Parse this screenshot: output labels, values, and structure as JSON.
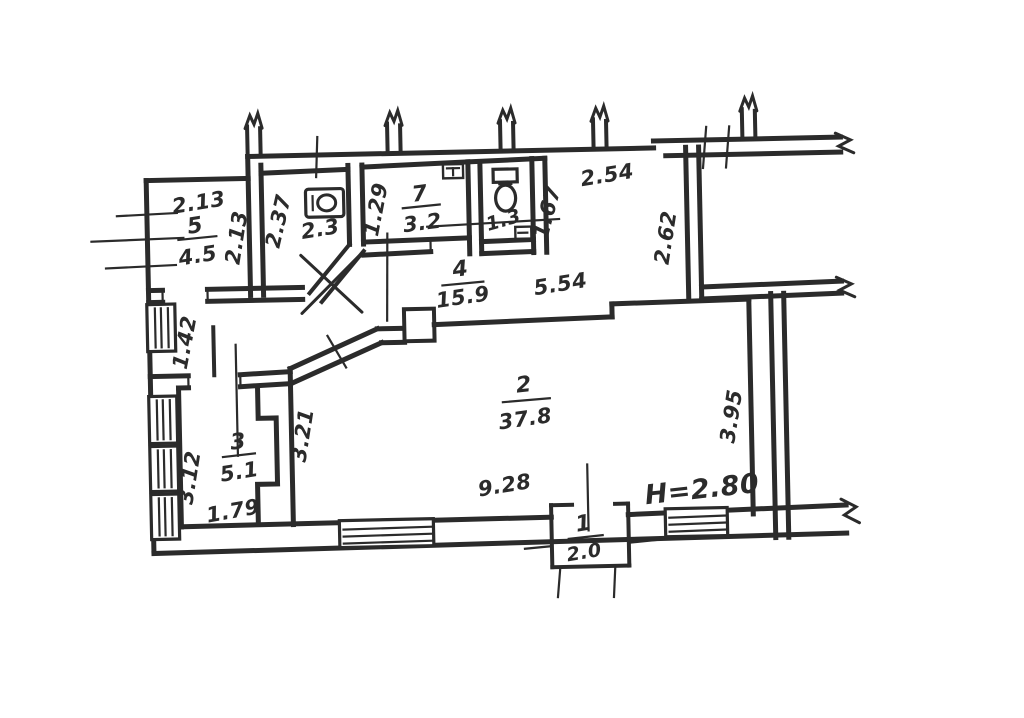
{
  "document": {
    "type": "scanned hand-drawn apartment floor plan",
    "ink_color": "#2b2b2b",
    "paper_color": "#ffffff"
  },
  "annotations": {
    "ceiling_height": "H=2.80"
  },
  "rooms": {
    "r1": {
      "number": "1",
      "area": "2.0"
    },
    "r2": {
      "number": "2",
      "area": "37.8"
    },
    "r3": {
      "number": "3",
      "area": "5.1"
    },
    "r4": {
      "number": "4",
      "area": "15.9"
    },
    "r5": {
      "number": "5",
      "area": "4.5"
    },
    "r6": {
      "area": "2.3"
    },
    "r7": {
      "number": "7",
      "area": "3.2"
    },
    "wc": {
      "area": "1.3"
    }
  },
  "dimensions": {
    "r5_width_top": "2.13",
    "r5_depth_right": "2.13",
    "r6_depth_left": "2.37",
    "r7_depth_left": "1.29",
    "wc_depth_right": "1.67",
    "hall_width_top": "2.54",
    "hall_depth_right": "2.62",
    "r4_width": "5.54",
    "r2_width_bottom": "9.28",
    "r2_depth_left": "3.21",
    "r2_depth_right": "3.95",
    "r3_depth_left": "3.12",
    "r3_width_bottom": "1.79",
    "lobby_depth_left": "1.42"
  },
  "icons": {
    "room6": "sink-icon",
    "room7": "vent-icon",
    "wc": "toilet-icon",
    "wc_corner": "drain-icon"
  }
}
